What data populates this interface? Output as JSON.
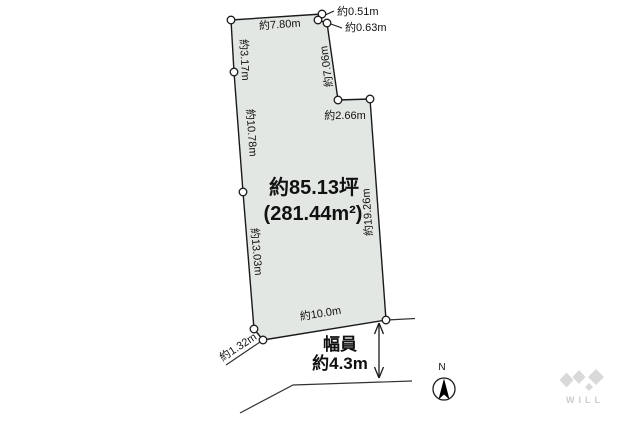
{
  "diagram": {
    "area_label": {
      "tsubo": "約85.13坪",
      "sqm": "(281.44m²)"
    },
    "dimensions": {
      "top_edge": "約7.80m",
      "top_step_1": "約0.51m",
      "top_step_2": "約0.63m",
      "upper_left_edge": "約3.17m",
      "upper_right_edge": "約7.06m",
      "right_step": "約2.66m",
      "left_edge_mid": "約10.78m",
      "right_edge": "約19.26m",
      "left_edge_lower": "約13.03m",
      "bottom_edge": "約10.0m",
      "corner_cut": "約1.32m"
    },
    "road": {
      "width_label_title": "幅員",
      "width_label_value": "約4.3m"
    },
    "compass": {
      "north_label": "N"
    },
    "logo": {
      "text": "WILL"
    },
    "colors": {
      "parcel_fill": "#e2e7e3",
      "line": "#1a1a1a",
      "logo_gray": "#d9d9d9"
    }
  }
}
